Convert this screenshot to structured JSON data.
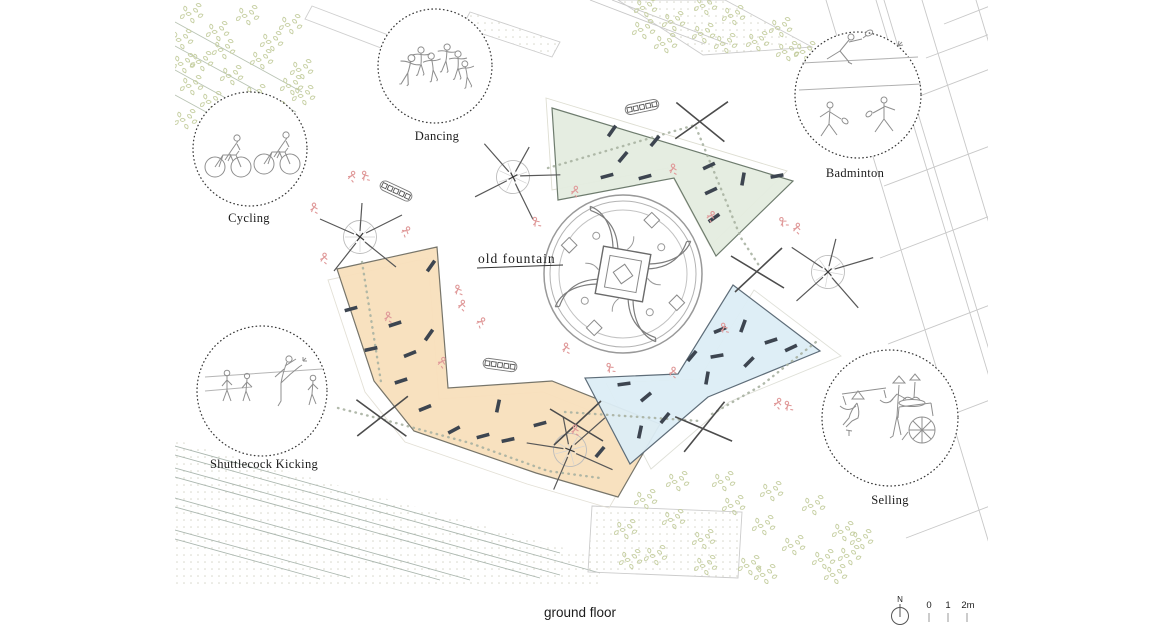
{
  "plan": {
    "fountain_label": "old fountain",
    "activity_labels": [
      "Cycling",
      "Dancing",
      "Badminton",
      "Shuttlecock Kicking",
      "Selling"
    ],
    "zone_colors": {
      "green": "#e4ecdf",
      "orange": "#f8dfbc",
      "blue": "#dcedf6"
    },
    "symbol_colors": {
      "bench": "#3d4550",
      "trail": "#a9b2a2",
      "figure_pink": "#e09a9a",
      "context_line": "#c8c8c8",
      "foliage": "#c6cfa2"
    }
  },
  "footer": {
    "floor_label": "ground floor"
  },
  "scale_bar": {
    "north_label": "N",
    "ticks": [
      "0",
      "1",
      "2m"
    ]
  }
}
